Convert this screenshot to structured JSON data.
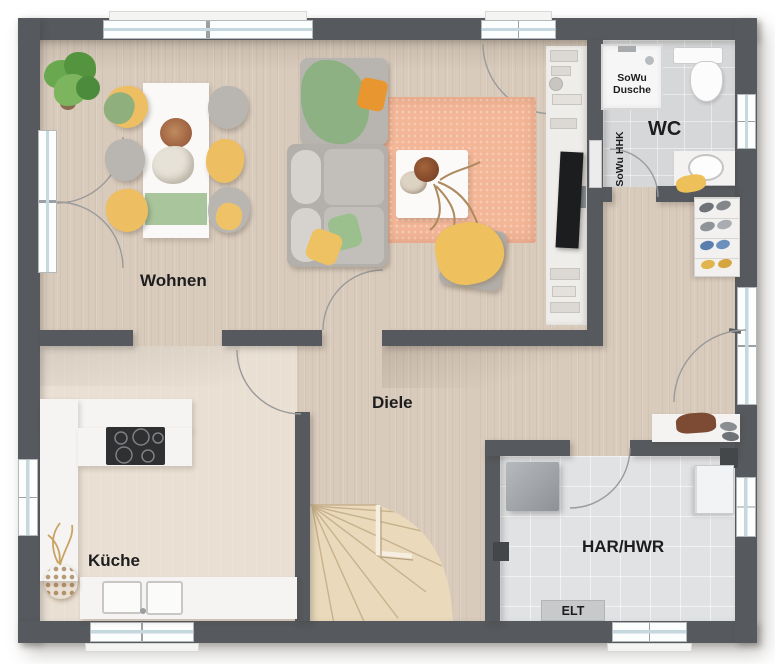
{
  "rooms": {
    "wohnen": {
      "label": "Wohnen"
    },
    "diele": {
      "label": "Diele"
    },
    "kueche": {
      "label": "Küche"
    },
    "wc": {
      "label": "WC"
    },
    "har_hwr": {
      "label": "HAR/HWR"
    }
  },
  "annotations": {
    "elt": {
      "label": "ELT"
    },
    "sowu_dusche": {
      "label": "SoWu Dusche"
    },
    "sowu_hhk": {
      "label": "SoWu HHK"
    }
  },
  "colors": {
    "wall": "#56595d",
    "floor_wood": "#d9cbbc",
    "floor_kitchen": "#e9dfd3",
    "floor_tile_wc": "#d6d7d9",
    "floor_tile_har": "#e1e2e4",
    "stairs_wood": "#ead9bb",
    "rug": "#f3b697",
    "accent_yellow": "#efc15e",
    "accent_green": "#9cbf8e",
    "accent_orange": "#e8962f",
    "window_frame": "#b4b8ba",
    "door_arc": "#9a9a9a"
  }
}
